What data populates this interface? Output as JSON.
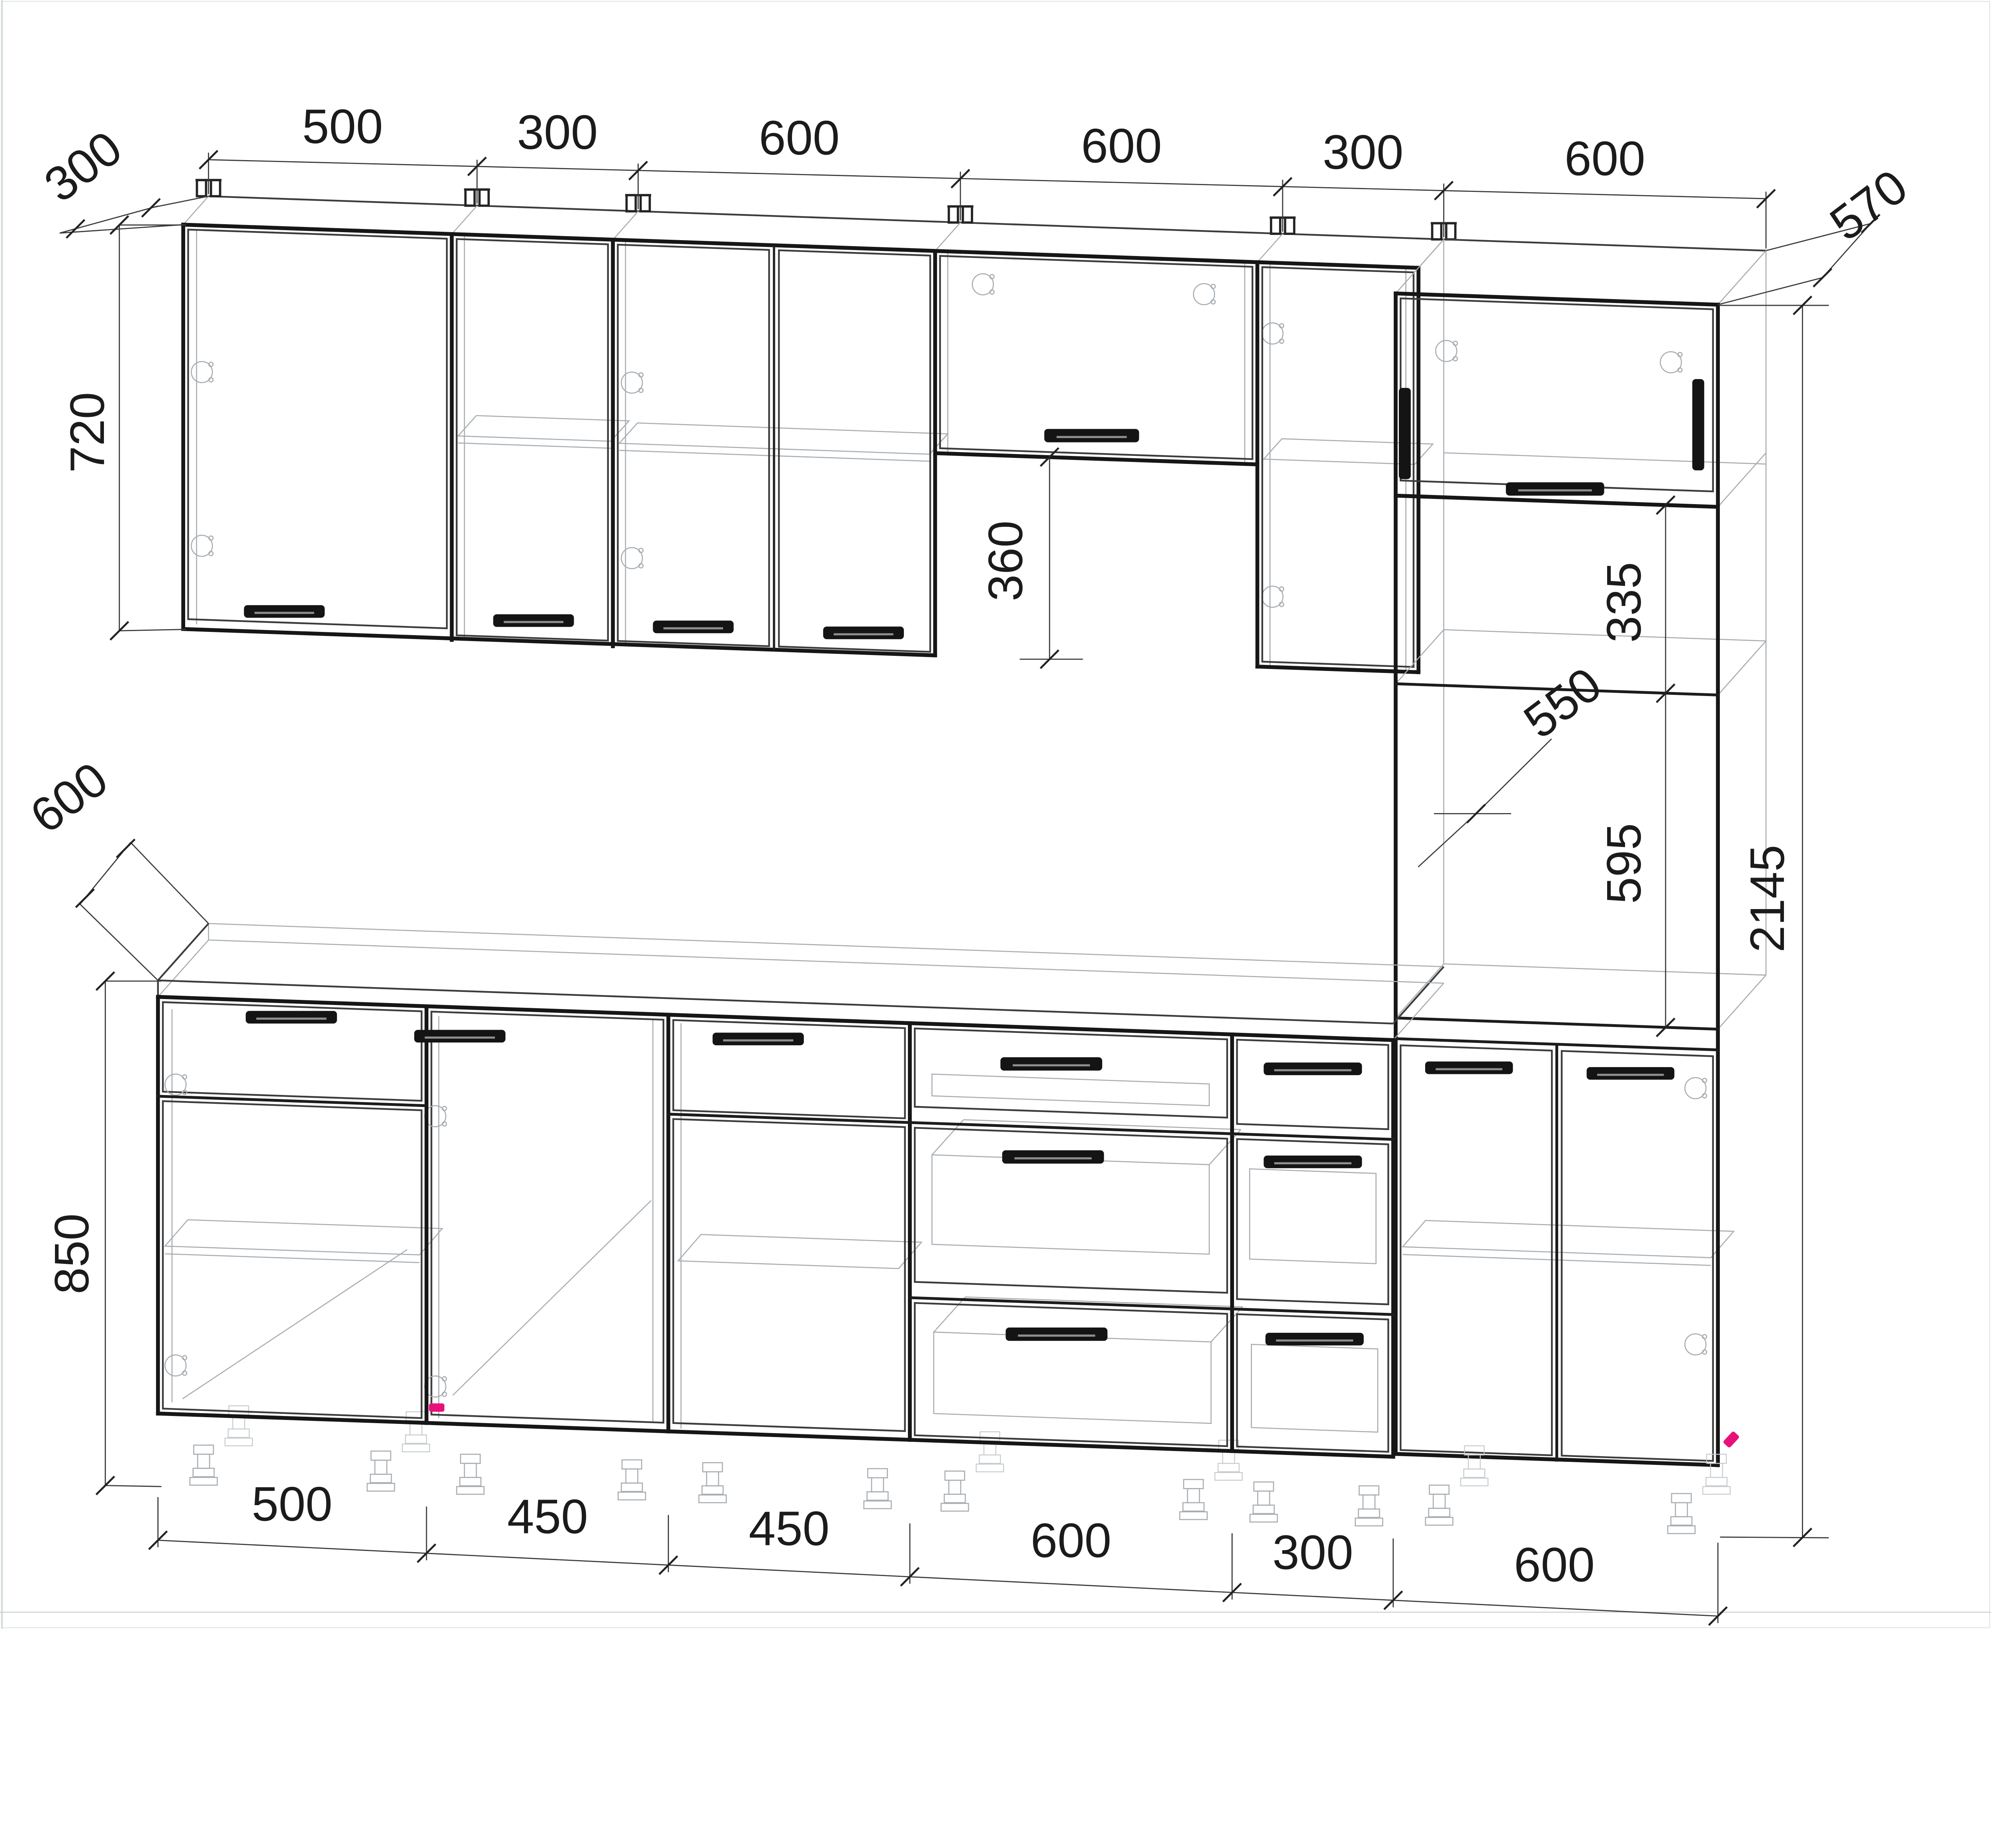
{
  "drawing": {
    "type": "kitchen-cabinet-technical-drawing",
    "style": "wireframe perspective line drawing, dimensions in mm",
    "background": "#ffffff",
    "line_color": "#161616",
    "wireframe_color": "#a7adb2",
    "accent_color": "#e8117a"
  },
  "dims": {
    "top": [
      "500",
      "300",
      "600",
      "600",
      "300",
      "600"
    ],
    "bottom": [
      "500",
      "450",
      "450",
      "600",
      "300",
      "600"
    ],
    "wall_depth": "300",
    "wall_height": "720",
    "hood_offset": "360",
    "base_depth": "600",
    "base_height": "850",
    "tall_depth": "570",
    "niche_height": "335",
    "niche_depth": "550",
    "oven_height": "595",
    "total_height": "2145"
  }
}
